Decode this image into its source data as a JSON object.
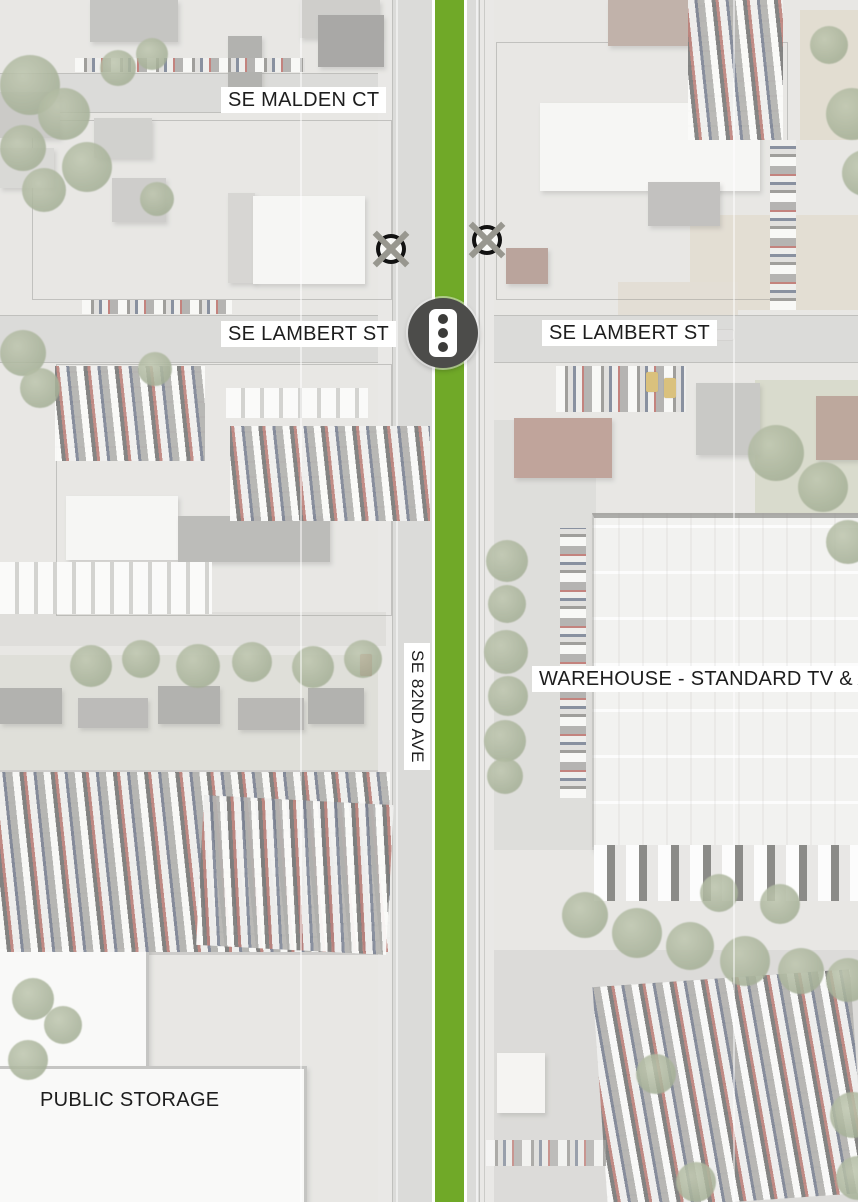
{
  "map": {
    "streets": {
      "malden_ct": "SE MALDEN CT",
      "lambert_st_west": "SE LAMBERT ST",
      "lambert_st_east": "SE LAMBERT ST",
      "eighty_second_ave": "SE 82ND AVE"
    },
    "buildings": {
      "warehouse": "WAREHOUSE - STANDARD TV & APPLIANCE",
      "public_storage": "PUBLIC STORAGE"
    },
    "markers": {
      "traffic_signal": "traffic-signal",
      "removed_crossing_west": "crossed-out-circle",
      "removed_crossing_east": "crossed-out-circle"
    },
    "colors": {
      "route_green": "#70A928",
      "signal_gray": "#4C4C4A",
      "x_marker_gray": "#98978F"
    }
  }
}
